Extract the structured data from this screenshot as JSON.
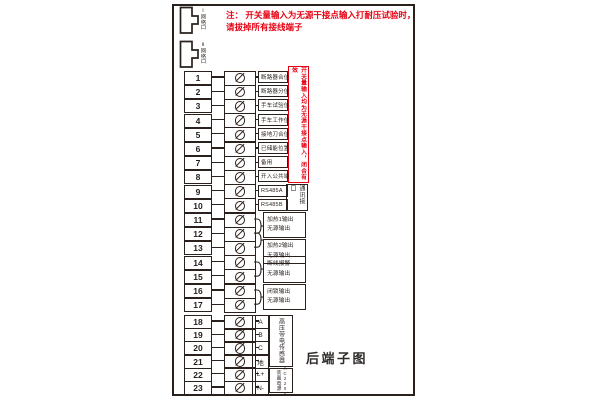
{
  "colors": {
    "accent_red": "#e60012",
    "line": "#2a211d",
    "background": "#ffffff"
  },
  "caption": "后端子图",
  "warning": {
    "line1": "注： 开关量输入为无源干接点输入打耐压试验时，",
    "line2": "请拔掉所有接线端子"
  },
  "connectors": [
    {
      "label": "Ⅰ网络口"
    },
    {
      "label": "Ⅱ网络口"
    }
  ],
  "terminals": [
    {
      "num": "1",
      "label": "断路器合位"
    },
    {
      "num": "2",
      "label": "断路器分位"
    },
    {
      "num": "3",
      "label": "手车试验位"
    },
    {
      "num": "4",
      "label": "手车工作位"
    },
    {
      "num": "5",
      "label": "接地刀合位"
    },
    {
      "num": "6",
      "label": "已储能位置"
    },
    {
      "num": "7",
      "label": "备用"
    },
    {
      "num": "8",
      "label": "开入公共端"
    },
    {
      "num": "9",
      "label": "RS485A"
    },
    {
      "num": "10",
      "label": "RS485B"
    },
    {
      "num": "11",
      "label": ""
    },
    {
      "num": "12",
      "label": ""
    },
    {
      "num": "13",
      "label": ""
    },
    {
      "num": "14",
      "label": ""
    },
    {
      "num": "15",
      "label": ""
    },
    {
      "num": "16",
      "label": ""
    },
    {
      "num": "17",
      "label": ""
    },
    {
      "num": "18",
      "label": "A",
      "small": true
    },
    {
      "num": "19",
      "label": "B",
      "small": true
    },
    {
      "num": "20",
      "label": "C",
      "small": true
    },
    {
      "num": "21",
      "label": "地",
      "small": true
    },
    {
      "num": "22",
      "label": "L+",
      "small": true
    },
    {
      "num": "23",
      "label": "N-",
      "small": true
    }
  ],
  "output_groups": [
    {
      "terminals": [
        11,
        12
      ],
      "line1": "加热1输出",
      "line2": "无源输出"
    },
    {
      "terminals": [
        12,
        13
      ],
      "line1": "加热2输出",
      "line2": "无源输出"
    },
    {
      "terminals": [
        14,
        15
      ],
      "line1": "断线报警",
      "line2": "无源输出"
    },
    {
      "terminals": [
        16,
        17
      ],
      "line1": "闭锁输出",
      "line2": "无源输出"
    }
  ],
  "side_notes": {
    "digital_input_note": "开关量输入均为无源干接点输入，闭合有效",
    "comm_port": "通讯接口",
    "hv_sensor": "高压带电传感器",
    "power_cjk": "装置电源",
    "power_rating": "AC220V"
  }
}
